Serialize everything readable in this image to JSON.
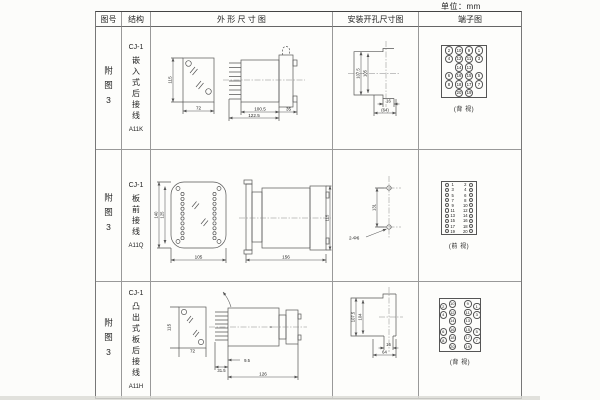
{
  "page": {
    "unit_label": "单位：mm"
  },
  "table": {
    "headers": [
      {
        "label": "图号"
      },
      {
        "label": "结构"
      },
      {
        "label": "外 形 尺 寸 图"
      },
      {
        "label": "安装开孔尺寸图"
      },
      {
        "label": "端子图"
      }
    ]
  },
  "rows": [
    {
      "figure_no": "附图3",
      "structure": {
        "model": "CJ-1",
        "desc": "嵌入式后接线",
        "code": "A11K"
      },
      "outline": {
        "front_height": "115",
        "front_width": "72",
        "side_body": "100.5",
        "side_total": "122.5",
        "side_flange": "35"
      },
      "install": {
        "outer": "107.5",
        "inner": "105",
        "slot": "16",
        "span": "(64)"
      },
      "terminal": {
        "caption": "(背 视)",
        "view": "rear",
        "rows": [
          [
            "2",
            "10",
            "9",
            "1"
          ],
          [
            "4",
            "12",
            "11",
            "3"
          ],
          [
            "",
            "14",
            "13",
            ""
          ],
          [
            "6",
            "16",
            "15",
            "5"
          ],
          [
            "8",
            "18",
            "17",
            "7"
          ],
          [
            "",
            "20",
            "19",
            ""
          ]
        ]
      }
    },
    {
      "figure_no": "附图3",
      "structure": {
        "model": "CJ-1",
        "desc": "板前接线",
        "code": "A11Q"
      },
      "outline": {
        "front_outer": "140",
        "front_inner": "125",
        "front_width": "105",
        "side_length": "156",
        "side_height": "115"
      },
      "install": {
        "pitch": "131",
        "holes": "2-Φ6"
      },
      "terminal": {
        "caption": "(前 视)",
        "view": "front",
        "rows": [
          [
            "1",
            "2"
          ],
          [
            "3",
            "4"
          ],
          [
            "5",
            "6"
          ],
          [
            "7",
            "8"
          ],
          [
            "9",
            "10"
          ],
          [
            "11",
            "12"
          ],
          [
            "13",
            "14"
          ],
          [
            "15",
            "16"
          ],
          [
            "17",
            "18"
          ],
          [
            "19",
            "20"
          ]
        ]
      }
    },
    {
      "figure_no": "附图3",
      "structure": {
        "model": "CJ-1",
        "desc": "凸出式板后接线",
        "code": "A11H"
      },
      "outline": {
        "front_height": "115",
        "front_width": "72",
        "side_comb": "31.5",
        "side_offset": "9.5",
        "side_length": "126"
      },
      "install": {
        "outer": "107.5",
        "inner": "104",
        "slot": "16",
        "span": "64"
      },
      "terminal": {
        "caption": "(背 视)",
        "view": "rear-wide",
        "rows": [
          [
            "2",
            "10",
            "9",
            "1"
          ],
          [
            "4",
            "12",
            "11",
            "3"
          ],
          [
            "",
            "14",
            "13",
            ""
          ],
          [
            "6",
            "16",
            "15",
            "5"
          ],
          [
            "8",
            "18",
            "17",
            "7"
          ],
          [
            "",
            "20",
            "19",
            ""
          ]
        ]
      }
    }
  ]
}
